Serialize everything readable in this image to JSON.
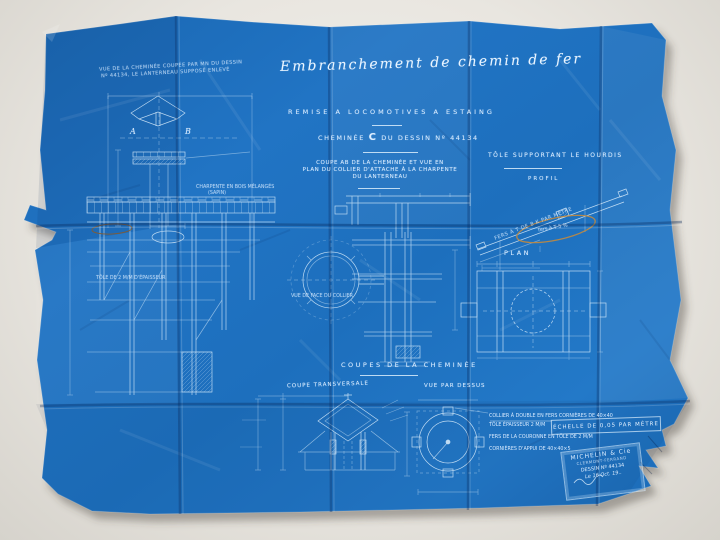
{
  "colors": {
    "paper_blue": "#1d6fbd",
    "backdrop": "#e9e6e0",
    "pencil_annotation": "#c18a3f",
    "line_white": "#dceefc"
  },
  "header": {
    "main_title": "Embranchement de chemin de fer",
    "subtitle": "REMISE A LOCOMOTIVES A ESTAING",
    "drawing_ref_pre": "CHEMINÉE",
    "drawing_ref_letter": "C",
    "drawing_ref_post": "DU DESSIN Nº 44134"
  },
  "labels": {
    "top_left_note_1": "VUE DE LA CHEMINÉE COUPÉE PAR MN DU DESSIN",
    "top_left_note_2": "Nº 44134, LE LANTERNEAU SUPPOSÉ ENLEVÉ",
    "marker_a": "A",
    "marker_b": "B",
    "center_note_1": "COUPE AB DE LA CHEMINÉE ET VUE EN",
    "center_note_2": "PLAN DU COLLIER D'ATTACHE À LA CHARPENTE",
    "center_note_3": "DU LANTERNEAU",
    "right_section_title": "TÔLE SUPPORTANT LE HOURDIS",
    "right_section_sub": "PROFIL",
    "diagonal_beam_label": "FERS À T DE 8 K PAR MÈTRE",
    "pencil_circled_note": "fers à T 5 %",
    "plan_label": "PLAN",
    "coupes_title": "COUPES DE LA CHEMINÉE",
    "coupe_transversale": "COUPE TRANSVERSALE",
    "vue_par_dessus": "VUE PAR DESSUS",
    "charpente_note_1": "CHARPENTE EN BOIS MÉLANGÉS",
    "charpente_note_2": "(SAPIN)",
    "tole_note": "TÔLE DE 2 M/M D'ÉPAISSEUR",
    "collier_note": "VUE DE FACE DU COLLIER"
  },
  "notes_block": [
    "COLLIER À DOUBLE EN FERS CORNIÈRES DE 40×40",
    "TÔLE ÉPAISSEUR 2 M/M",
    "FERS DE LA COURONNE EN TÔLE DE 2 M/M",
    "CORNIÈRES D'APPUI DE 40×40×5"
  ],
  "scale_box": {
    "text": "ÉCHELLE DE 0,05 PAR MÈTRE"
  },
  "stamp": {
    "company": "MICHELIN & Cie",
    "city": "CLERMONT-FERRAND",
    "drawing_no": "DESSIN Nº 44134",
    "date": "Le 16 Oct. 19.."
  }
}
